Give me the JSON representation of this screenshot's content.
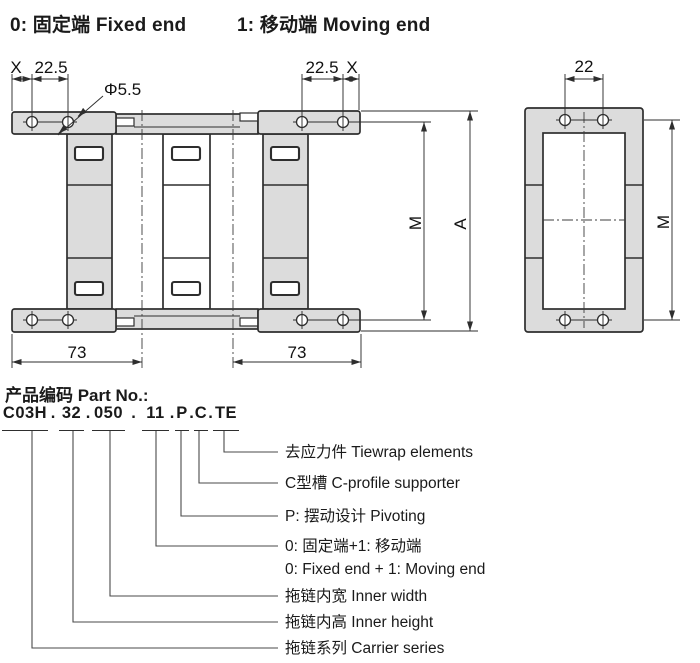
{
  "legend": {
    "fixed_end": "0: 固定端 Fixed end",
    "moving_end": "1: 移动端 Moving end"
  },
  "dims": {
    "x_left": "X",
    "s225_left": "22.5",
    "dia": "Φ5.5",
    "s225_right": "22.5",
    "x_right": "X",
    "s22": "22",
    "m_top_view": "M",
    "a": "A",
    "m_front_view": "M",
    "s73_left": "73",
    "s73_right": "73"
  },
  "part": {
    "heading": "产品编码 Part No.:",
    "code": "C03H.32.050.11.P.C.TE",
    "segments": [
      "C03H",
      "32",
      "050",
      "11",
      "P",
      "C",
      "TE"
    ],
    "dot": "."
  },
  "callouts": [
    {
      "text": "去应力件 Tiewrap elements"
    },
    {
      "text": "C型槽 C-profile supporter"
    },
    {
      "text": "P: 摆动设计 Pivoting"
    },
    {
      "text": "0: 固定端+1: 移动端",
      "text2": "0: Fixed end + 1: Moving end"
    },
    {
      "text": "拖链内宽 Inner width"
    },
    {
      "text": "拖链内高 Inner height"
    },
    {
      "text": "拖链系列 Carrier series"
    }
  ],
  "colors": {
    "line": "#2e2e2e",
    "gray_fill": "#dcdcdc",
    "text": "#1a1a1a"
  }
}
